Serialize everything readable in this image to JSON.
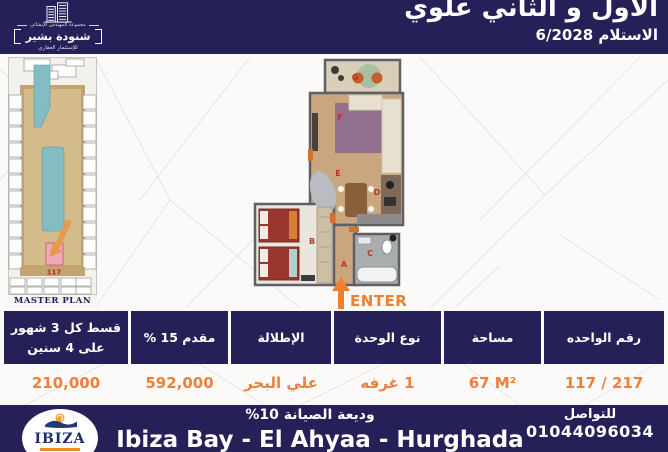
{
  "brand": {
    "group": "مجموعة المهندس الإنشائي",
    "name": "شنودة بشير",
    "tagline": "للإستثمار العقاري"
  },
  "header": {
    "title": "الأول و الثاني علوي",
    "delivery": "الاستلام 6/2028"
  },
  "master_plan": {
    "label": "MASTER PLAN",
    "unit_number": "117"
  },
  "floor_plan": {
    "enter_label": "ENTER",
    "room_labels": {
      "a": "A",
      "b": "B",
      "c": "C",
      "d": "D",
      "e": "E",
      "f": "F",
      "g": "G"
    }
  },
  "table": {
    "columns": [
      {
        "header": "قسط كل 3 شهور على 4 سنين",
        "value": "210,000"
      },
      {
        "header": "مقدم 15 %",
        "value": "592,000"
      },
      {
        "header": "الإطلالة",
        "value": "علي البحر"
      },
      {
        "header": "نوع الوحدة",
        "value": "1 غرفه"
      },
      {
        "header": "مساحة",
        "value": "67 M²"
      },
      {
        "header": "رقم الواحده",
        "value": "117 / 217"
      }
    ]
  },
  "footer": {
    "logo_text": "IBIZA",
    "maintenance": "وديعة الصيانة 10%",
    "location": "Ibiza Bay - El Ahyaa - Hurghada",
    "contact_label": "للتواصل",
    "phone": "01044096034"
  },
  "colors": {
    "navy": "#252058",
    "orange": "#ee7f3d",
    "enter_orange": "#f07f2e",
    "pool_teal": "#84bcc4",
    "highlight_pink": "#f0a8bc"
  }
}
